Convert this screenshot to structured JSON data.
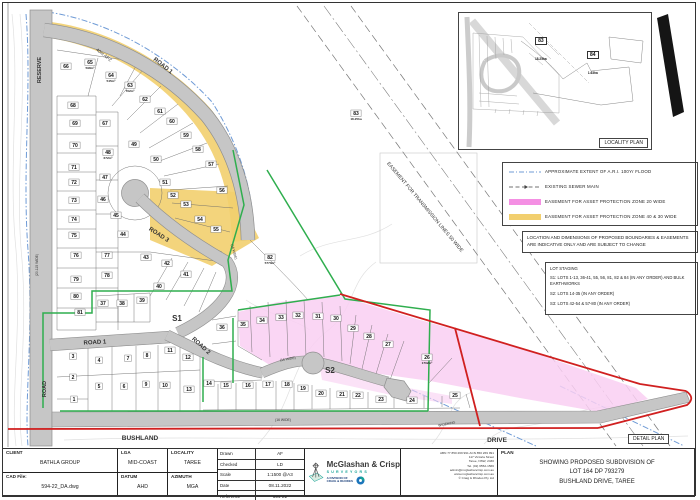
{
  "colors": {
    "apz_yellow": "#F2CF6E",
    "apz_pink": "#F48FE3",
    "apz_pink_fill": "#F9CFF2",
    "stage_green": "#2FAE4E",
    "boundary_red": "#D02020",
    "flood_blue": "#6F9BD6",
    "road_gray": "#C6C6C6",
    "teal": "#17A398",
    "logo_blue": "#1B75BB"
  },
  "plan": {
    "lots": [
      {
        "n": "1",
        "x": 74,
        "y": 404
      },
      {
        "n": "2",
        "x": 73,
        "y": 382
      },
      {
        "n": "3",
        "x": 73,
        "y": 361
      },
      {
        "n": "4",
        "x": 99,
        "y": 365
      },
      {
        "n": "5",
        "x": 99,
        "y": 391
      },
      {
        "n": "6",
        "x": 124,
        "y": 391
      },
      {
        "n": "7",
        "x": 128,
        "y": 363
      },
      {
        "n": "8",
        "x": 147,
        "y": 360
      },
      {
        "n": "9",
        "x": 146,
        "y": 389
      },
      {
        "n": "10",
        "x": 165,
        "y": 390
      },
      {
        "n": "11",
        "x": 170,
        "y": 355
      },
      {
        "n": "12",
        "x": 188,
        "y": 362
      },
      {
        "n": "13",
        "x": 189,
        "y": 394
      },
      {
        "n": "14",
        "x": 209,
        "y": 388
      },
      {
        "n": "15",
        "x": 226,
        "y": 390
      },
      {
        "n": "16",
        "x": 248,
        "y": 390
      },
      {
        "n": "17",
        "x": 268,
        "y": 389
      },
      {
        "n": "18",
        "x": 287,
        "y": 389
      },
      {
        "n": "19",
        "x": 303,
        "y": 393
      },
      {
        "n": "20",
        "x": 321,
        "y": 398
      },
      {
        "n": "21",
        "x": 342,
        "y": 399
      },
      {
        "n": "22",
        "x": 358,
        "y": 400
      },
      {
        "n": "23",
        "x": 381,
        "y": 404
      },
      {
        "n": "24",
        "x": 412,
        "y": 405
      },
      {
        "n": "25",
        "x": 455,
        "y": 400
      },
      {
        "n": "26",
        "x": 427,
        "y": 362,
        "area": "1702m²"
      },
      {
        "n": "27",
        "x": 388,
        "y": 349
      },
      {
        "n": "28",
        "x": 369,
        "y": 341
      },
      {
        "n": "29",
        "x": 353,
        "y": 333
      },
      {
        "n": "30",
        "x": 336,
        "y": 323
      },
      {
        "n": "31",
        "x": 318,
        "y": 321
      },
      {
        "n": "32",
        "x": 298,
        "y": 320
      },
      {
        "n": "33",
        "x": 281,
        "y": 322
      },
      {
        "n": "34",
        "x": 262,
        "y": 325
      },
      {
        "n": "35",
        "x": 243,
        "y": 329
      },
      {
        "n": "36",
        "x": 222,
        "y": 332
      },
      {
        "n": "37",
        "x": 103,
        "y": 308
      },
      {
        "n": "38",
        "x": 122,
        "y": 308
      },
      {
        "n": "39",
        "x": 142,
        "y": 305
      },
      {
        "n": "40",
        "x": 159,
        "y": 291
      },
      {
        "n": "41",
        "x": 186,
        "y": 279
      },
      {
        "n": "42",
        "x": 167,
        "y": 268
      },
      {
        "n": "43",
        "x": 146,
        "y": 262
      },
      {
        "n": "44",
        "x": 123,
        "y": 239
      },
      {
        "n": "45",
        "x": 116,
        "y": 220
      },
      {
        "n": "46",
        "x": 103,
        "y": 204
      },
      {
        "n": "47",
        "x": 105,
        "y": 182
      },
      {
        "n": "48",
        "x": 108,
        "y": 157,
        "area": "672m²"
      },
      {
        "n": "49",
        "x": 134,
        "y": 149
      },
      {
        "n": "50",
        "x": 156,
        "y": 164
      },
      {
        "n": "51",
        "x": 165,
        "y": 187
      },
      {
        "n": "52",
        "x": 173,
        "y": 200
      },
      {
        "n": "53",
        "x": 186,
        "y": 209
      },
      {
        "n": "54",
        "x": 200,
        "y": 224
      },
      {
        "n": "55",
        "x": 216,
        "y": 234
      },
      {
        "n": "56",
        "x": 222,
        "y": 195
      },
      {
        "n": "57",
        "x": 211,
        "y": 169
      },
      {
        "n": "58",
        "x": 198,
        "y": 154
      },
      {
        "n": "59",
        "x": 186,
        "y": 140
      },
      {
        "n": "60",
        "x": 172,
        "y": 126
      },
      {
        "n": "61",
        "x": 160,
        "y": 116
      },
      {
        "n": "62",
        "x": 145,
        "y": 104
      },
      {
        "n": "63",
        "x": 130,
        "y": 90,
        "area": "762m²"
      },
      {
        "n": "64",
        "x": 111,
        "y": 80,
        "area": "545m²"
      },
      {
        "n": "65",
        "x": 90,
        "y": 67,
        "area": "598m²"
      },
      {
        "n": "66",
        "x": 66,
        "y": 71
      },
      {
        "n": "67",
        "x": 105,
        "y": 128
      },
      {
        "n": "68",
        "x": 73,
        "y": 110
      },
      {
        "n": "69",
        "x": 75,
        "y": 128
      },
      {
        "n": "70",
        "x": 75,
        "y": 150
      },
      {
        "n": "71",
        "x": 74,
        "y": 172
      },
      {
        "n": "72",
        "x": 74,
        "y": 187
      },
      {
        "n": "73",
        "x": 74,
        "y": 205
      },
      {
        "n": "74",
        "x": 74,
        "y": 224
      },
      {
        "n": "75",
        "x": 74,
        "y": 240
      },
      {
        "n": "76",
        "x": 76,
        "y": 260
      },
      {
        "n": "77",
        "x": 107,
        "y": 260
      },
      {
        "n": "78",
        "x": 107,
        "y": 280
      },
      {
        "n": "79",
        "x": 76,
        "y": 284
      },
      {
        "n": "80",
        "x": 76,
        "y": 301
      },
      {
        "n": "81",
        "x": 80,
        "y": 317
      },
      {
        "n": "82",
        "x": 270,
        "y": 262,
        "area": "5770m²"
      },
      {
        "n": "83",
        "x": 356,
        "y": 118,
        "area": "18.25ha"
      }
    ],
    "labels": [
      {
        "text": "RESERVE",
        "x": 41,
        "y": 70,
        "rot": -90,
        "size": 5.5,
        "bold": true
      },
      {
        "text": "ROAD 1",
        "x": 162,
        "y": 67,
        "rot": 38,
        "size": 6,
        "bold": true
      },
      {
        "text": "40m APZ",
        "x": 103,
        "y": 56,
        "rot": 38,
        "size": 4.5,
        "bold": false
      },
      {
        "text": "ROAD 3",
        "x": 158,
        "y": 236,
        "rot": 33,
        "size": 6,
        "bold": true
      },
      {
        "text": "ROAD 1",
        "x": 95,
        "y": 344,
        "rot": -3,
        "size": 6,
        "bold": true
      },
      {
        "text": "ROAD 2",
        "x": 200,
        "y": 347,
        "rot": 42,
        "size": 6,
        "bold": true
      },
      {
        "text": "ROAD",
        "x": 46,
        "y": 389,
        "rot": -90,
        "size": 5.5,
        "bold": true
      },
      {
        "text": "BUSHLAND",
        "x": 140,
        "y": 440,
        "rot": 0,
        "size": 6.5,
        "bold": true
      },
      {
        "text": "DRIVE",
        "x": 497,
        "y": 442,
        "rot": 0,
        "size": 6.5,
        "bold": true
      },
      {
        "text": "EASEMENT FOR TRANSMISSION LINES 50 WIDE",
        "x": 424,
        "y": 208,
        "rot": 50,
        "size": 5,
        "bold": false
      },
      {
        "text": "S1",
        "x": 177,
        "y": 321,
        "rot": 0,
        "size": 8,
        "bold": true,
        "color": "#2FAE4E"
      },
      {
        "text": "S2",
        "x": 330,
        "y": 373,
        "rot": 0,
        "size": 8,
        "bold": true,
        "color": "#D02020"
      },
      {
        "text": "(16 WIDE)",
        "x": 233,
        "y": 252,
        "rot": 75,
        "size": 3.4,
        "bold": false
      },
      {
        "text": "(16 WIDE)",
        "x": 288,
        "y": 360,
        "rot": -10,
        "size": 3.4,
        "bold": false
      },
      {
        "text": "(16 WIDE)",
        "x": 283,
        "y": 421,
        "rot": 0,
        "size": 3.4,
        "bold": false
      },
      {
        "text": "WIDENING",
        "x": 447,
        "y": 425,
        "rot": -12,
        "size": 3.4,
        "bold": false
      },
      {
        "text": "(20.115 WIDE)",
        "x": 38,
        "y": 265,
        "rot": -90,
        "size": 3.4,
        "bold": false
      }
    ]
  },
  "locality": {
    "label": "LOCALITY PLAN",
    "lot83": {
      "n": "83",
      "area": "18.25ha"
    },
    "lot84": {
      "n": "84",
      "area": "1.63ha"
    }
  },
  "legend": {
    "items": [
      {
        "swatch": "flood",
        "text": "APPROXIMATE EXTENT OF A.R.I. 100Yr FLOOD"
      },
      {
        "swatch": "sewer",
        "text": "EXISTING SEWER MAIN"
      },
      {
        "swatch": "pink",
        "text": "EASEMENT FOR ASSET PROTECTION ZONE 20 WIDE"
      },
      {
        "swatch": "yellow",
        "text": "EASEMENT FOR ASSET PROTECTION ZONE 40 & 30 WIDE"
      }
    ]
  },
  "note": "LOCATION AND DIMENSIONS OF PROPOSED BOUNDARIES & EASEMENTS ARE INDICATIVE ONLY AND ARE SUBJECT TO CHANGE",
  "staging": {
    "title": "LOT STAGING",
    "items": [
      "S1: LOTS 1-13, 36-41, 55, 56, 81, 82 & 84 (IN ANY ORDER) AND BULK EARTHWORKS",
      "S2: LOTS 14-35 (IN ANY ORDER)",
      "S3: LOTS 42-54 & 57-80 (IN ANY ORDER)"
    ]
  },
  "detail_label": "DETAIL PLAN",
  "titleblock": {
    "client_label": "CLIENT",
    "client": "BATHLA GROUP",
    "cadfile_label": "CAD File:",
    "cadfile": "594-22_DA.dwg",
    "lga_label": "LGA",
    "lga": "MID-COAST",
    "locality_label": "LOCALITY",
    "locality": "TAREE",
    "datum_label": "DATUM",
    "datum": "AHD",
    "azimuth_label": "AZIMUTH",
    "azimuth": "MGA",
    "rows": [
      [
        "Drawn",
        "AF"
      ],
      [
        "Checked",
        "LD"
      ],
      [
        "Scale",
        "1:1500 @A3"
      ],
      [
        "Date",
        "08.11.2022"
      ],
      [
        "Reference",
        "594-22"
      ]
    ],
    "firm": "McGlashan & Crisp",
    "firm_sub": "SURVEYORS",
    "division_line1": "A DIVISION OF",
    "division_line2": "CRAIG & RHODES",
    "contact": [
      "ABN 77 850 269 991   ACN 850 269 991",
      "117 Victoria Street",
      "Taree, NSW, 2430",
      "Tel. (02) 6552-1566",
      "admin@mcglashancrisp.com.au",
      "www.mcglashancrisp.com.au",
      "© Craig & Rhodes Pty Ltd"
    ],
    "plan_label": "PLAN",
    "plan_lines": [
      "SHOWING PROPOSED SUBDIVISION OF",
      "LOT 164 DP 793279",
      "BUSHLAND DRIVE, TAREE"
    ]
  }
}
